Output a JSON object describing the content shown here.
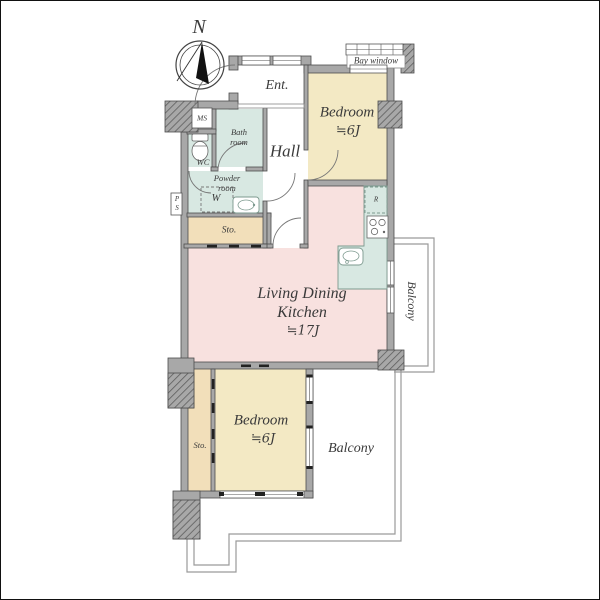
{
  "plan": {
    "compass": {
      "label": "N"
    },
    "rooms": {
      "bay_window": {
        "label": "Bay window"
      },
      "entrance": {
        "label": "Ent."
      },
      "bedroom_top": {
        "name": "Bedroom",
        "size": "≒6J"
      },
      "hall": {
        "label": "Hall"
      },
      "meter_space": {
        "label": "MS"
      },
      "bathroom": {
        "line1": "Bath",
        "line2": "room"
      },
      "toilet": {
        "label": "WC"
      },
      "powder_room": {
        "line1": "Powder",
        "line2": "room"
      },
      "washer_space": {
        "label": "W"
      },
      "pipe_space": {
        "label": "PS"
      },
      "storage_upper": {
        "label": "Sto."
      },
      "refrigerator_space": {
        "label": "R"
      },
      "ldk": {
        "line1": "Living Dining",
        "line2": "Kitchen",
        "size": "≒17J"
      },
      "balcony_right": {
        "label": "Balcony"
      },
      "bedroom_bottom": {
        "name": "Bedroom",
        "size": "≒6J"
      },
      "storage_lower": {
        "label": "Sto."
      },
      "balcony_bottom": {
        "label": "Balcony"
      }
    },
    "colors": {
      "bedroom_fill": "#f3e9c4",
      "ldk_fill": "#f8e1df",
      "wet_area_fill": "#d8e8e2",
      "storage_fill": "#f2dfba",
      "wall_fill": "#a8a8a8",
      "wall_outline": "#4c4c4c",
      "balcony_line": "#9a9a9a",
      "label_text": "#3a3a3a"
    }
  }
}
